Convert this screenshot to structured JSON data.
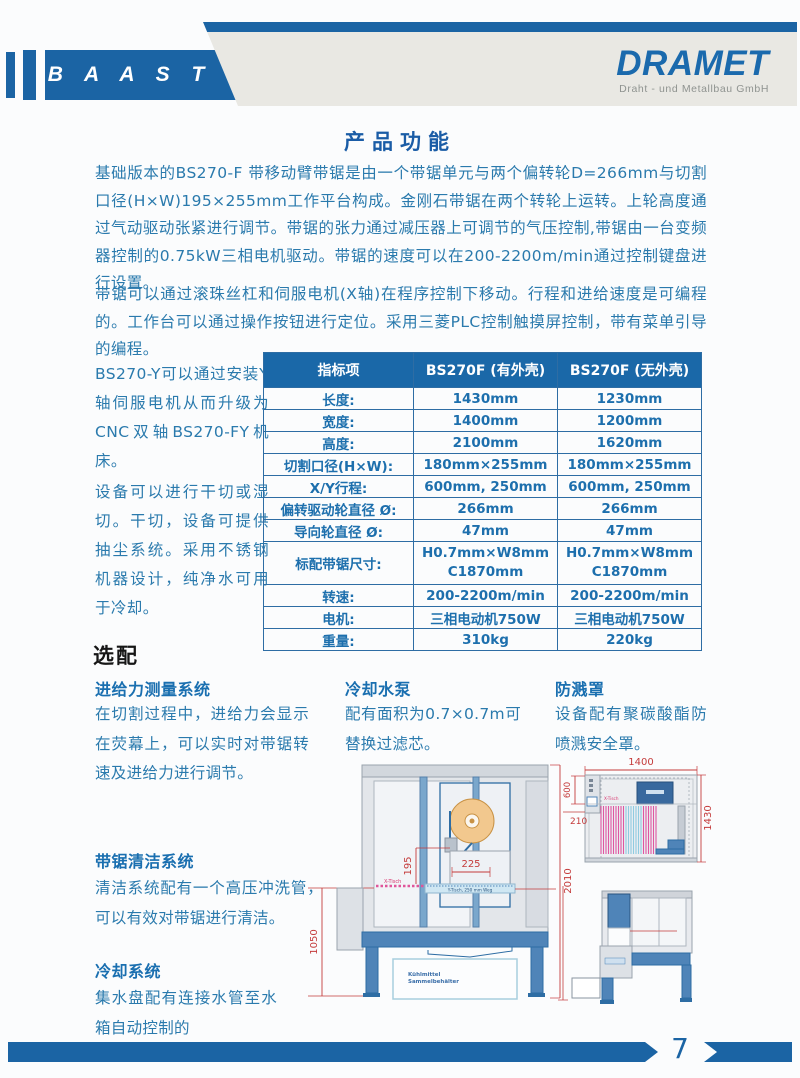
{
  "colors": {
    "brand_blue": "#1b64a4",
    "body_text_blue": "#2a7aad",
    "table_header_bg": "#1a68a8",
    "table_border_blue": "#2e6da4",
    "dimension_red": "#c43b3b",
    "curtain_pink": "#df56a1",
    "banner_gray": "#e9e8e3"
  },
  "header": {
    "brand_left": "B A A S T",
    "brand_right": "DRAMET",
    "brand_right_sub": "Draht - und Metallbau GmbH"
  },
  "title": "产品功能",
  "intro": {
    "p1": "基础版本的BS270-F 带移动臂带锯是由一个带锯单元与两个偏转轮D=266mm与切割口径(H×W)195×255mm工作平台构成。金刚石带锯在两个转轮上运转。上轮高度通过气动驱动张紧进行调节。带锯的张力通过减压器上可调节的气压控制,带锯由一台变频器控制的0.75kW三相电机驱动。带锯的速度可以在200-2200m/min通过控制键盘进行设置。",
    "p2": "带锯可以通过滚珠丝杠和伺服电机(X轴)在程序控制下移动。行程和进给速度是可编程的。工作台可以通过操作按钮进行定位。采用三菱PLC控制触摸屏控制，带有菜单引导的编程。",
    "p3": "BS270-Y可以通过安装Y轴伺服电机从而升级为CNC双轴BS270-FY机床。",
    "p4": "设备可以进行干切或湿切。干切，设备可提供抽尘系统。采用不锈钢机器设计，纯净水可用于冷却。"
  },
  "spec_table": {
    "headers": [
      "指标项",
      "BS270F (有外壳)",
      "BS270F (无外壳)"
    ],
    "rows": [
      {
        "label": "长度:",
        "with_housing": "1430mm",
        "without_housing": "1230mm"
      },
      {
        "label": "宽度:",
        "with_housing": "1400mm",
        "without_housing": "1200mm"
      },
      {
        "label": "高度:",
        "with_housing": "2100mm",
        "without_housing": "1620mm"
      },
      {
        "label": "切割口径(H×W):",
        "with_housing": "180mm×255mm",
        "without_housing": "180mm×255mm"
      },
      {
        "label": "X/Y行程:",
        "with_housing": "600mm, 250mm",
        "without_housing": "600mm, 250mm"
      },
      {
        "label": "偏转驱动轮直径 Ø:",
        "with_housing": "266mm",
        "without_housing": "266mm"
      },
      {
        "label": "导向轮直径 Ø:",
        "with_housing": "47mm",
        "without_housing": "47mm"
      },
      {
        "label": "标配带锯尺寸:",
        "with_housing": "H0.7mm×W8mm\nC1870mm",
        "without_housing": "H0.7mm×W8mm\nC1870mm"
      },
      {
        "label": "转速:",
        "with_housing": "200-2200m/min",
        "without_housing": "200-2200m/min"
      },
      {
        "label": "电机:",
        "with_housing": "三相电动机750W",
        "without_housing": "三相电动机750W"
      },
      {
        "label": "重量:",
        "with_housing": "310kg",
        "without_housing": "220kg"
      }
    ]
  },
  "options": {
    "heading": "选配",
    "feed_force": {
      "title": "进给力测量系统",
      "text": "在切割过程中，进给力会显示在荧幕上，可以实时对带锯转速及进给力进行调节。"
    },
    "pump": {
      "title": "冷却水泵",
      "text": "配有面积为0.7×0.7m可替换过滤芯。"
    },
    "guard": {
      "title": "防溅罩",
      "text": "设备配有聚碳酸酯防喷溅安全罩。"
    },
    "cleaning": {
      "title": "带锯清洁系统",
      "text": "清洁系统配有一个高压冲洗管，可以有效对带锯进行清洁。"
    },
    "cooling": {
      "title": "冷却系统",
      "text": "集水盘配有连接水管至水箱自动控制的"
    }
  },
  "drawings": {
    "front_view": {
      "dim_left_height": "1050",
      "dim_total_height": "2010",
      "dim_cut_height": "195",
      "dim_cut_width": "225",
      "label_x_table": "X-Tisch",
      "label_y_table": "Y-Tisch, 250 mm Weg",
      "tank_line1": "Kühlmittel",
      "tank_line2": "Sammelbehälter"
    },
    "top_view": {
      "dim_width": "1400",
      "dim_left_depth": "600",
      "dim_left_offset": "210",
      "dim_depth": "1430",
      "label_x_table": "X-Tisch"
    }
  },
  "footer": {
    "page_number": "7"
  }
}
